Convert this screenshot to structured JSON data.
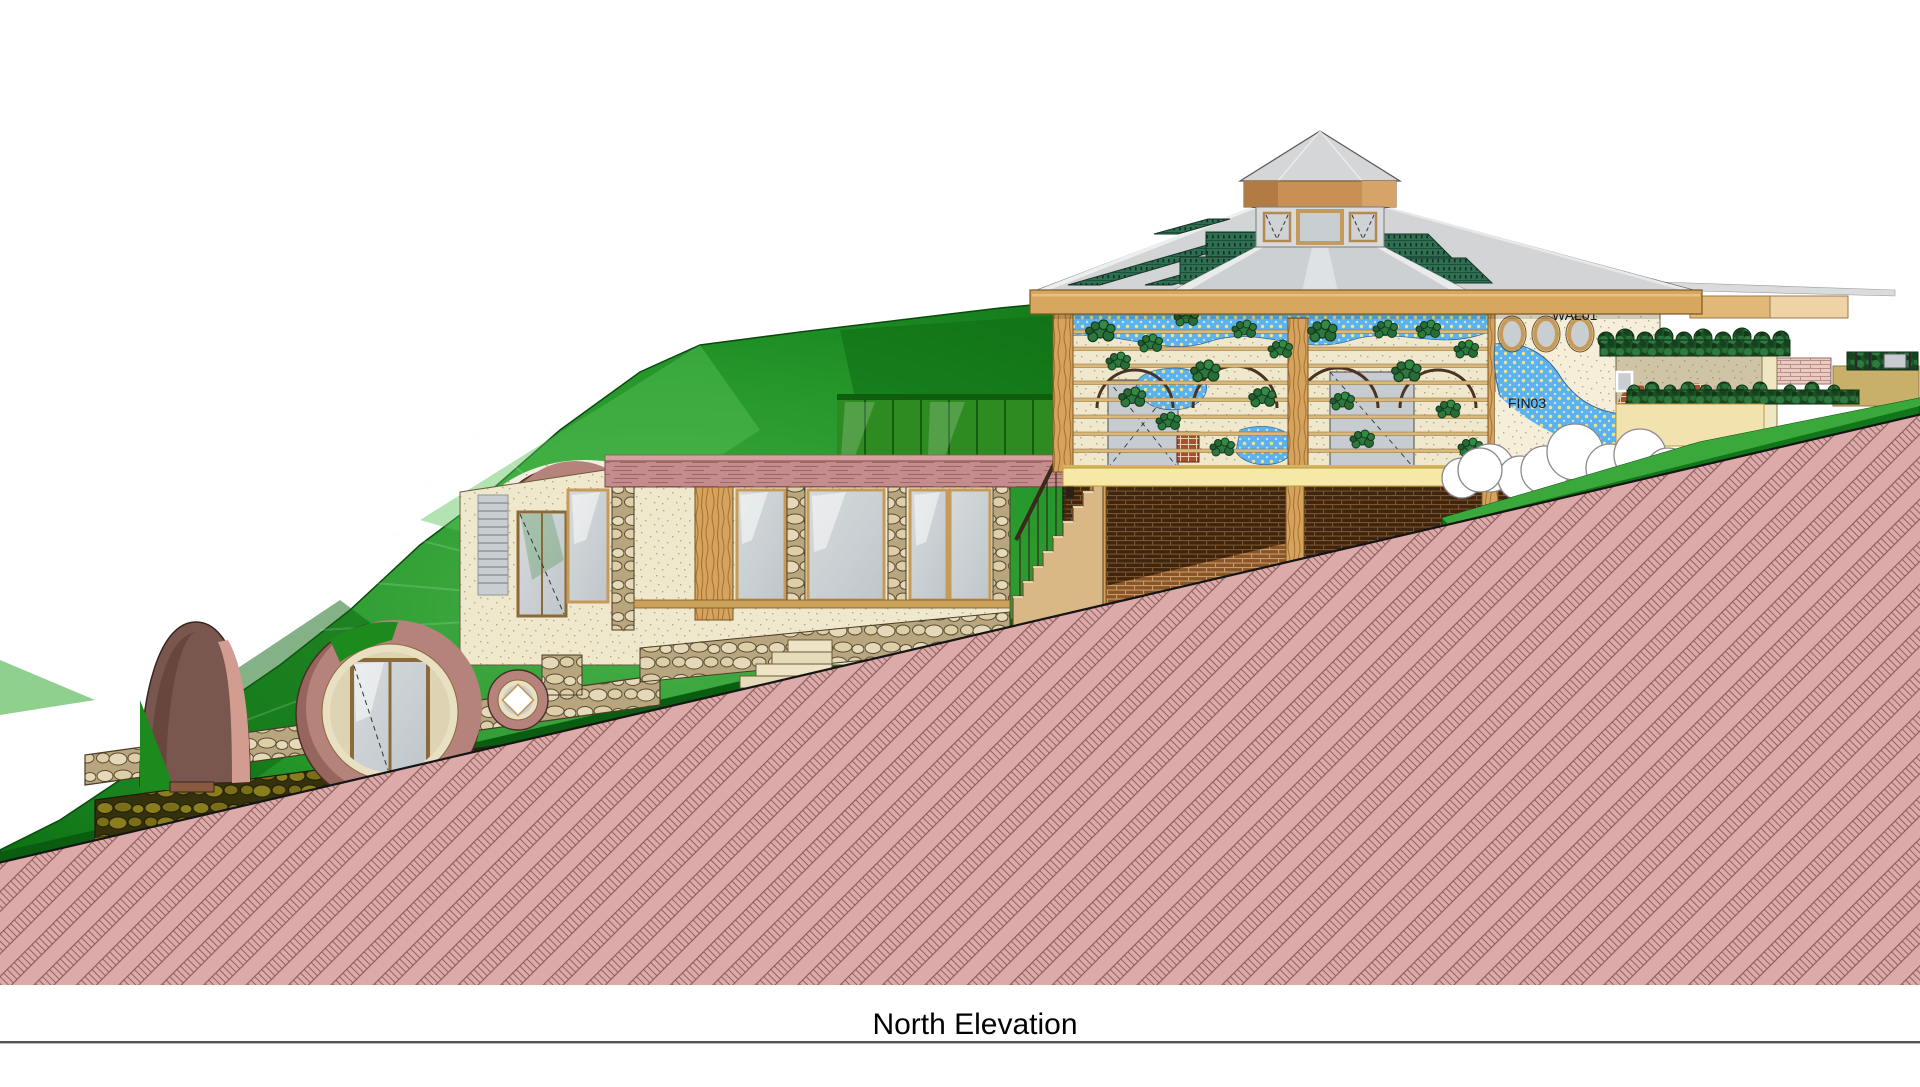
{
  "drawing": {
    "title": "North Elevation",
    "annotations": {
      "wall_tag": "WAL01",
      "finish_tag": "FIN03"
    },
    "colors": {
      "earth_hatch_bg": "#dcaaa8",
      "earth_hatch_line": "#8a5a5a",
      "grass_green": "#24962a",
      "roof_shingle_green": "#2e6e51",
      "fascia_tan": "#d8a75f",
      "mosaic_blue": "#5cb2ee",
      "ring_mauve": "#b5837b",
      "basement_brick": "#40250e",
      "stucco_cream": "#efe8cc"
    }
  }
}
